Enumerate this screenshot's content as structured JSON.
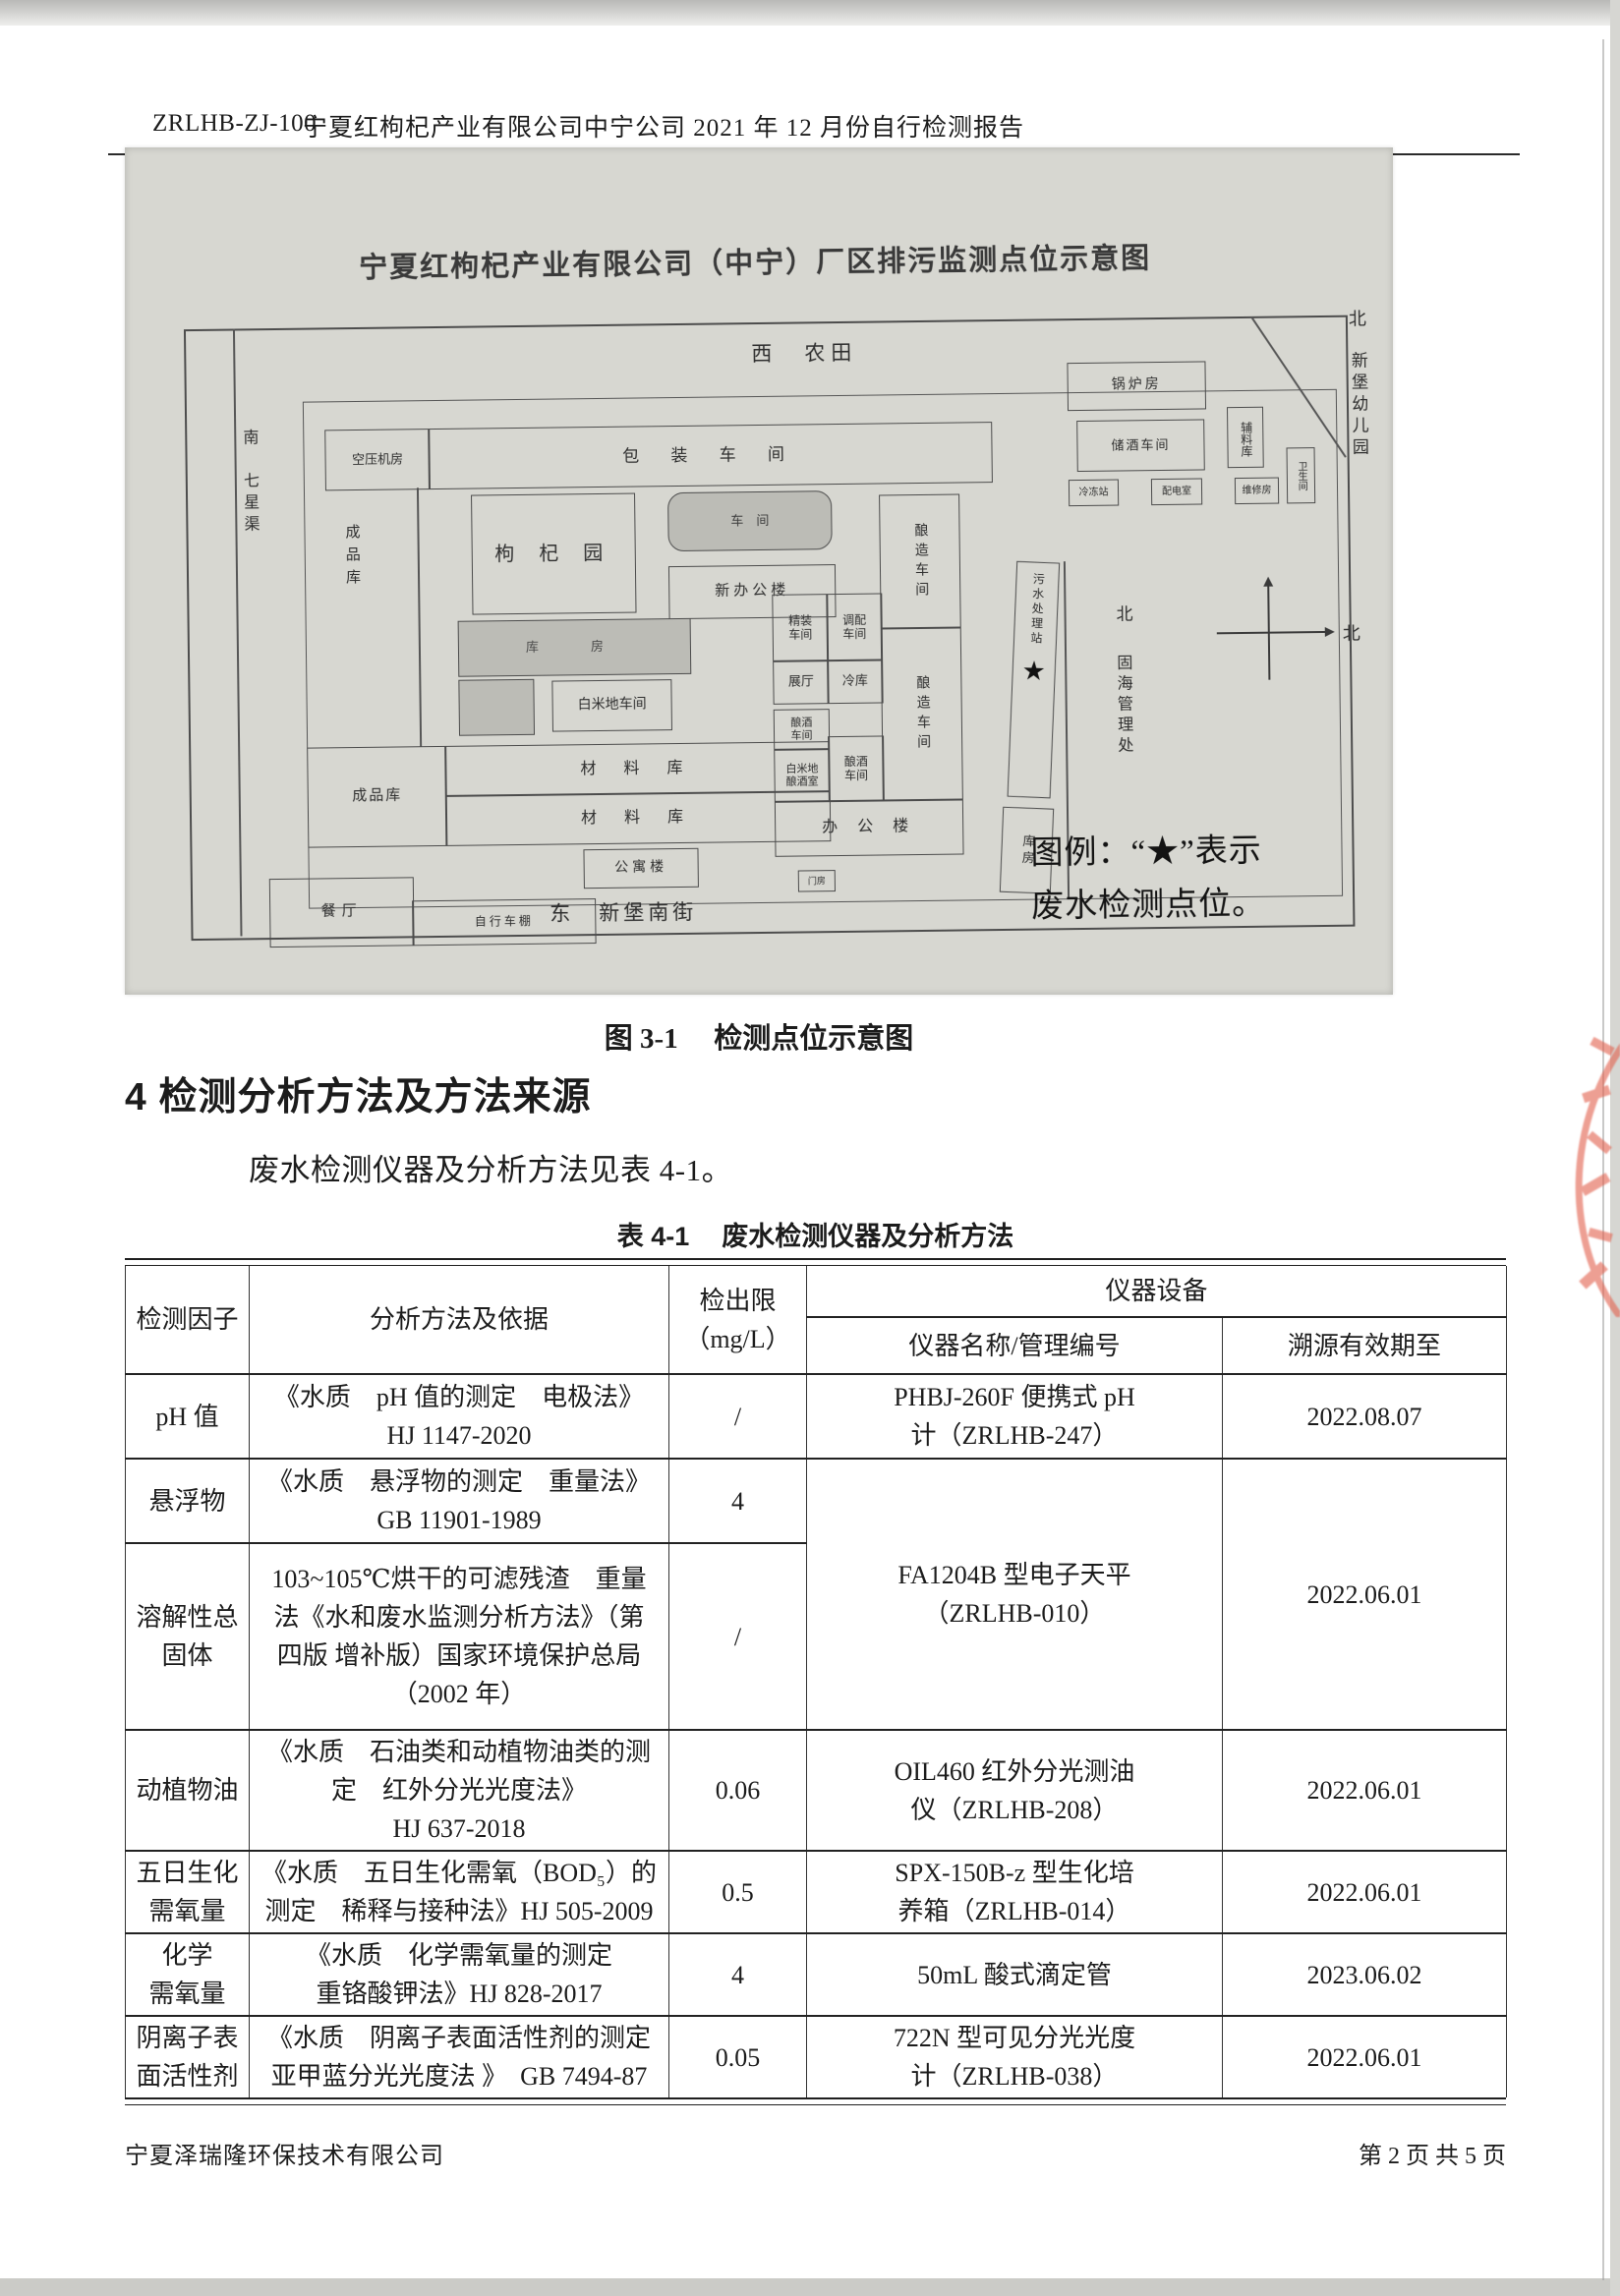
{
  "header": {
    "doc_code": "ZRLHB-ZJ-100",
    "title": "宁夏红枸杞产业有限公司中宁公司 2021 年 12 月份自行检测报告"
  },
  "map": {
    "title": "宁夏红枸杞产业有限公司（中宁）厂区排污监测点位示意图",
    "legend_line1": "图例：“★”表示",
    "legend_line2": "废水检测点位。",
    "star": "★",
    "surroundings": {
      "west": "西　农田",
      "south_canal": "南　七星渠",
      "east_street": "东　新堡南街",
      "north_out": "北",
      "kindergarten": "新堡幼儿园",
      "north_in": "北",
      "management": "固海管理处",
      "compass_north": "北"
    },
    "b": {
      "kongya": "空压机房",
      "baozhuang": "包 装 车 间",
      "guolu": "锅炉房",
      "chujiu": "储酒车间",
      "fuliao": "辅料库",
      "lengdong": "冷冻站",
      "peidian": "配电室",
      "weixiu": "维修房",
      "weisheng": "卫生间",
      "gouqi": "枸 杞 园",
      "chejian": "车　间",
      "xinban": "新办公楼",
      "niangzao": "酿造车间",
      "kufang_band": "库　房",
      "baimi": "白米地车间",
      "jingzhuang": "精装\n车间",
      "tiaopei": "调配\n车间",
      "zhanting": "展厅",
      "lengku": "冷库",
      "niangjiu1": "酿酒\n车间",
      "baimi_niangjiu": "白米地\n酿酒室",
      "niangjiu2": "酿酒\n车间",
      "bangong": "办 公 楼",
      "wushui": "污水处理站",
      "kufang": "库房",
      "chengpin_tall": "成品库",
      "chengpin": "成品库",
      "cailiao1": "材 料 库",
      "cailiao2": "材 料 库",
      "gongyu": "公寓楼",
      "canting": "餐厅",
      "zixingche": "自行车棚",
      "menfang": "门房"
    }
  },
  "figure_caption": {
    "label": "图 3-1",
    "text": "检测点位示意图"
  },
  "section": {
    "heading": "4 检测分析方法及方法来源",
    "intro": "废水检测仪器及分析方法见表 4-1。"
  },
  "table": {
    "caption_label": "表 4-1",
    "caption_text": "废水检测仪器及分析方法",
    "headers": {
      "factor": "检测因子",
      "method": "分析方法及依据",
      "limit": "检出限\n（mg/L）",
      "equipment": "仪器设备",
      "instrument": "仪器名称/管理编号",
      "valid": "溯源有效期至"
    },
    "rows": [
      {
        "factor": "pH 值",
        "method": "《水质　pH 值的测定　电极法》\nHJ 1147-2020",
        "limit": "/",
        "instrument": "PHBJ-260F 便携式 pH\n计（ZRLHB-247）",
        "valid": "2022.08.07"
      },
      {
        "factor": "悬浮物",
        "method": "《水质　悬浮物的测定　重量法》\nGB 11901-1989",
        "limit": "4",
        "instrument": "FA1204B 型电子天平\n（ZRLHB-010）",
        "valid": "2022.06.01"
      },
      {
        "factor": "溶解性总\n固体",
        "method": "103~105℃烘干的可滤残渣　重量\n法《水和废水监测分析方法》（第\n四版 增补版）国家环境保护总局\n（2002 年）",
        "limit": "/"
      },
      {
        "factor": "动植物油",
        "method": "《水质　石油类和动植物油类的测\n定　红外分光光度法》\nHJ 637-2018",
        "limit": "0.06",
        "instrument": "OIL460 红外分光测油\n仪（ZRLHB-208）",
        "valid": "2022.06.01"
      },
      {
        "factor": "五日生化\n需氧量",
        "method": "《水质　五日生化需氧（BOD₅）的\n测定　稀释与接种法》HJ 505-2009",
        "limit": "0.5",
        "instrument": "SPX-150B-z 型生化培\n养箱（ZRLHB-014）",
        "valid": "2022.06.01"
      },
      {
        "factor": "化学\n需氧量",
        "method": "《水质　化学需氧量的测定\n重铬酸钾法》HJ 828-2017",
        "limit": "4",
        "instrument": "50mL 酸式滴定管",
        "valid": "2023.06.02"
      },
      {
        "factor": "阴离子表\n面活性剂",
        "method": "《水质　阴离子表面活性剂的测定\n亚甲蓝分光光度法 》　GB 7494-87",
        "limit": "0.05",
        "instrument": "722N 型可见分光光度\n计（ZRLHB-038）",
        "valid": "2022.06.01"
      }
    ]
  },
  "footer": {
    "company": "宁夏泽瑞隆环保技术有限公司",
    "page_info": "第 2 页 共 5 页"
  },
  "colors": {
    "stamp_red": "#e2604d",
    "map_bg": "#d7d7d1"
  }
}
